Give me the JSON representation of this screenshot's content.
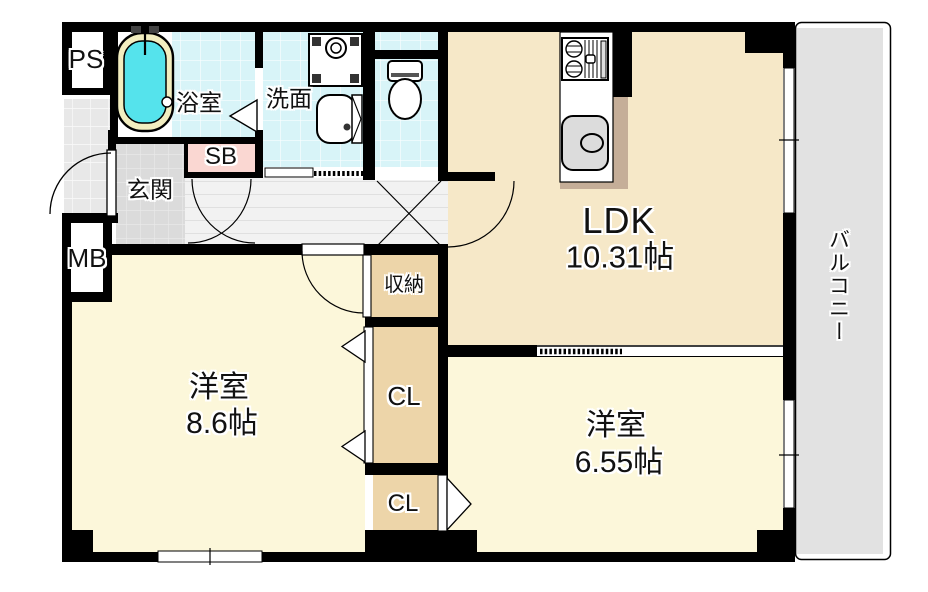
{
  "rooms": {
    "ps": {
      "label": "PS"
    },
    "bathroom": {
      "label": "浴室"
    },
    "washroom": {
      "label": "洗面"
    },
    "shoe_box": {
      "label": "SB"
    },
    "entrance": {
      "label": "玄関"
    },
    "meter_box": {
      "label": "MB"
    },
    "ldk": {
      "label": "LDK",
      "size": "10.31帖"
    },
    "storage": {
      "label": "収納"
    },
    "closet_upper": {
      "label": "CL"
    },
    "closet_lower": {
      "label": "CL"
    },
    "bedroom_left": {
      "label": "洋室",
      "size": "8.6帖"
    },
    "bedroom_right": {
      "label": "洋室",
      "size": "6.55帖"
    },
    "balcony": {
      "label": "バルコニー"
    }
  },
  "colors": {
    "room-cream": "#FCF7DA",
    "ldk-cream": "#F6E8C8",
    "closet-tan": "#EDD5A9",
    "counter-shadow": "#C5AE98",
    "tile-cyan": "#D8F4F8",
    "tub-water": "#55E3EC",
    "tub-rim": "#F2EEC0",
    "sb-pink": "#FAD7D2",
    "genkan-gray": "#DBDBDB",
    "porch-gray": "#E8E8E8",
    "hallway-gray": "#F2F2F2",
    "balcony-gray": "#E2E2E2",
    "fixture-gray": "#DCDCDC",
    "wall": "#000000"
  }
}
